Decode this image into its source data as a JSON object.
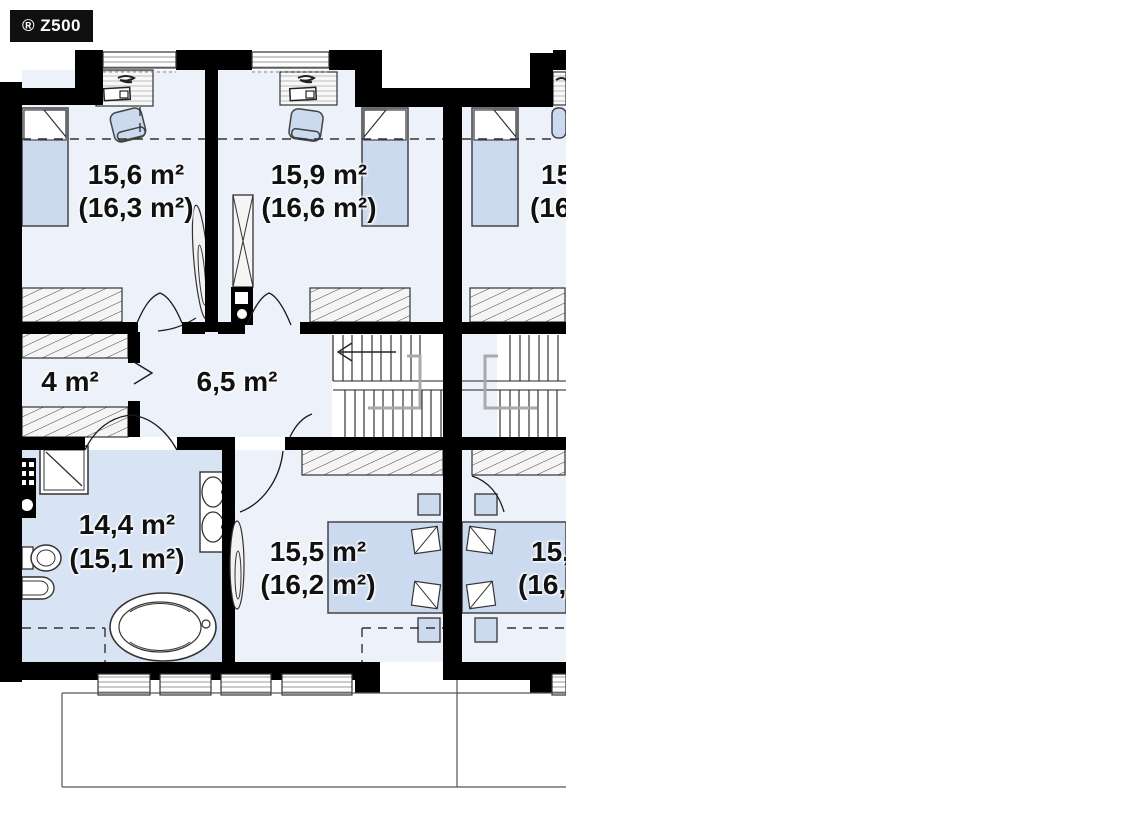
{
  "badge": {
    "label": "® Z500"
  },
  "rooms": {
    "bedroom_top_left": {
      "area": "15,6 m²",
      "gross": "(16,3 m²)"
    },
    "bedroom_top_middle": {
      "area": "15,9 m²",
      "gross": "(16,6 m²)"
    },
    "bedroom_top_right_truncated": {
      "area": "15",
      "gross": "(16"
    },
    "closet": {
      "area": "4 m²"
    },
    "hallway": {
      "area": "6,5 m²"
    },
    "bathroom": {
      "area": "14,4 m²",
      "gross": "(15,1 m²)"
    },
    "bedroom_bottom_middle": {
      "area": "15,5 m²",
      "gross": "(16,2 m²)"
    },
    "bedroom_bottom_right_truncated": {
      "area": "15,",
      "gross": "(16,"
    }
  },
  "colors": {
    "wall": "#000000",
    "bedroom_floor": "#edf1f9",
    "bathroom_floor": "#d8e3f4",
    "furniture_blue": "#ccdaf0",
    "hatch_fill": "#f5f5f5",
    "railing_gray": "#aaaaaa",
    "badge_bg": "#101010",
    "badge_text": "#ffffff"
  }
}
